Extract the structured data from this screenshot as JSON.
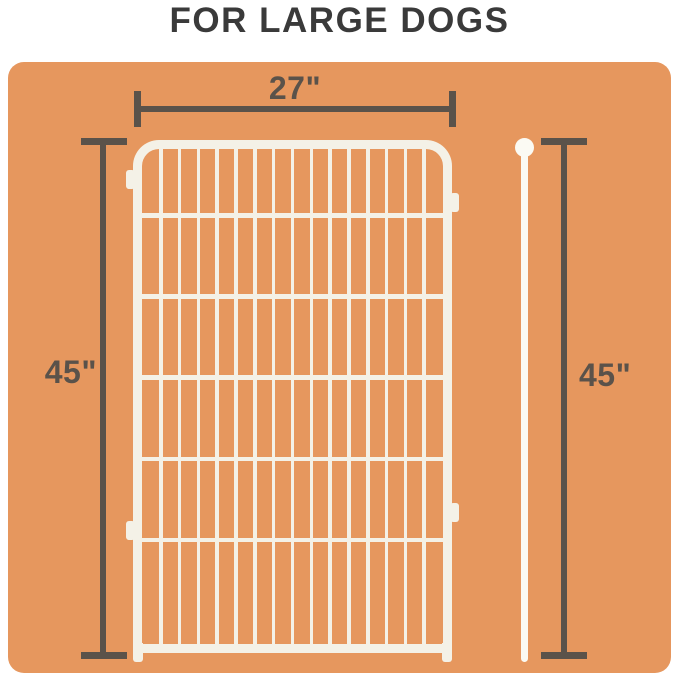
{
  "title": {
    "text": "FOR LARGE DOGS"
  },
  "dimensions": {
    "width_label": "27\"",
    "left_height_label": "45\"",
    "right_height_label": "45\""
  },
  "fence": {
    "vertical_bars": 15,
    "horizontal_rails": 5,
    "left_tabs": 2,
    "right_tabs": 2
  },
  "colors": {
    "page_background": "#FFFFFF",
    "panel": "#E6975E",
    "fence": "#F4F1E7",
    "rod": "#FBFAF3",
    "dimension": "#5A524A",
    "title": "#3A3A3A"
  }
}
